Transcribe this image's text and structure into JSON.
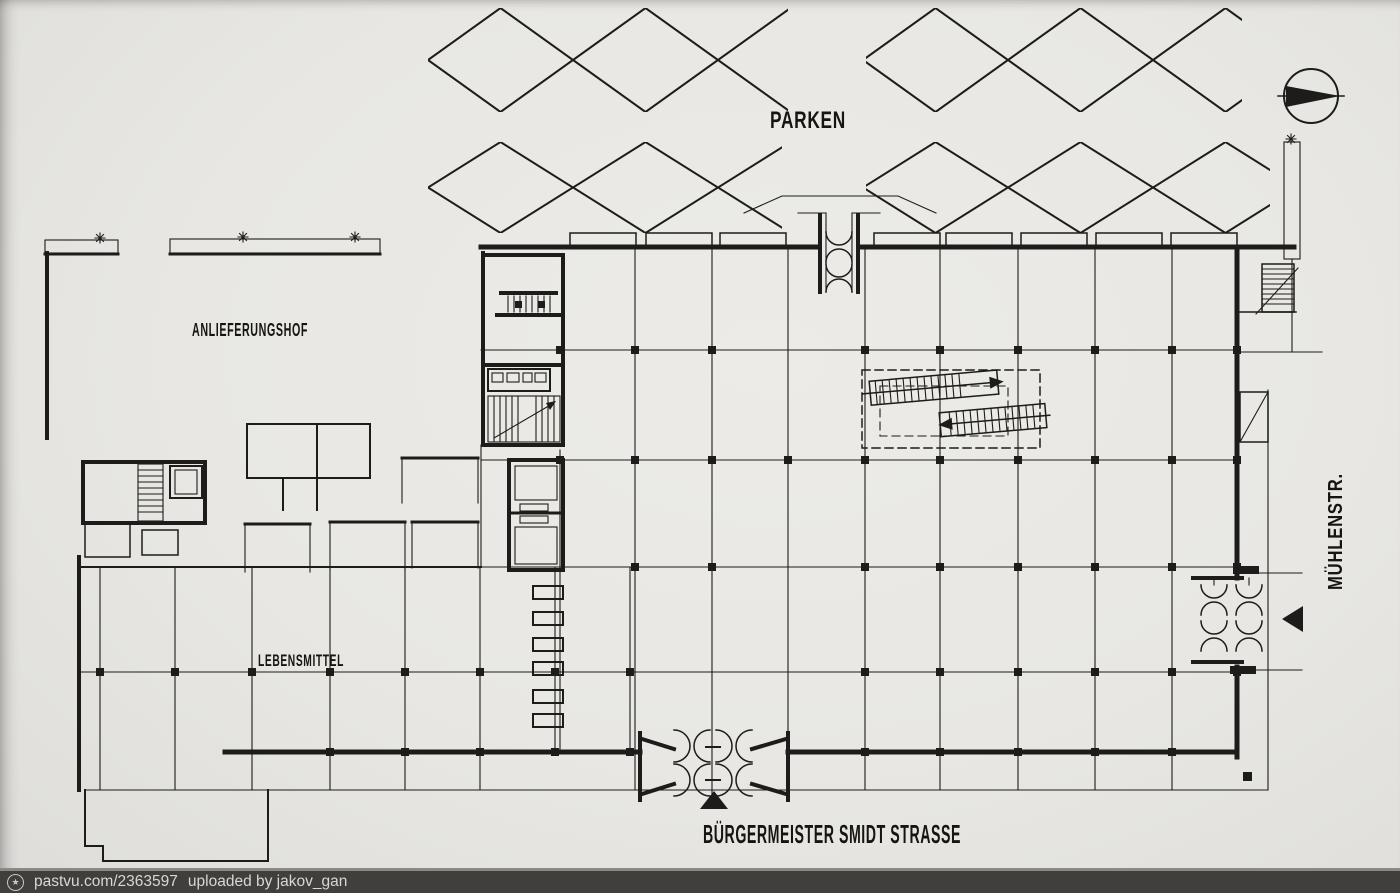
{
  "page": {
    "paper_color": "#e8e7e3",
    "ink_color": "#1d1c1a"
  },
  "plan_labels": {
    "parken": "PARKEN",
    "anlieferungshof": "ANLIEFERUNGSHOF",
    "lebensmittel": "LEBENSMITTEL",
    "muehlenstr": "MÜHLENSTR.",
    "strasse": "BÜRGERMEISTER SMIDT STRASSE"
  },
  "symbols": {
    "north_compass": "north-compass-icon",
    "entrance_marker": "filled-triangle",
    "parking_stalls": "diagonal-diamond-lattice",
    "planting_strip": "stippled-band"
  },
  "watermark": {
    "icon": "pastvu-star-circle-icon",
    "site": "pastvu.com/2363597",
    "uploaded_by": "uploaded by jakov_gan",
    "bar_color": "#413f3c",
    "text_color": "#d8d7d3"
  }
}
